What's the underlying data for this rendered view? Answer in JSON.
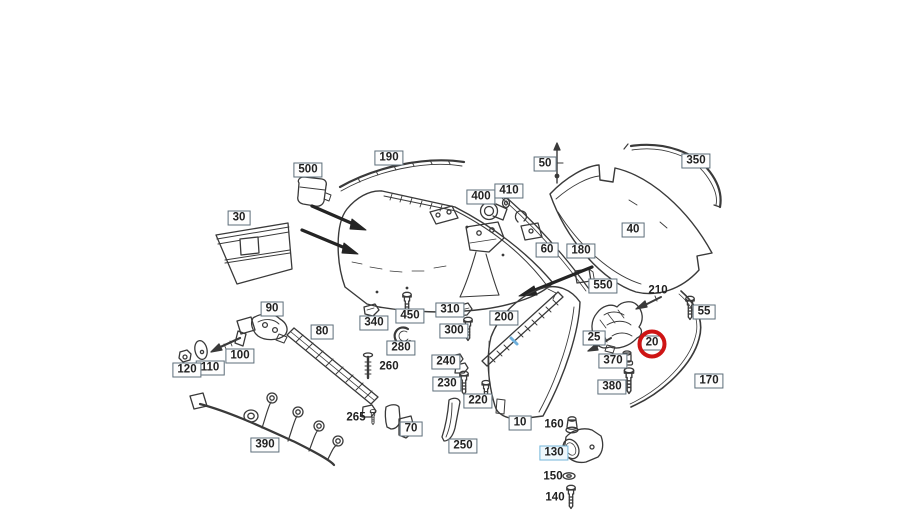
{
  "diagram": {
    "kind": "exploded-parts-diagram",
    "subject": "rear bumper assembly parts catalog drawing",
    "selected_callout": "20"
  },
  "colors": {
    "background": "#ffffff",
    "line": "#3a3a3a",
    "label_text": "#222222",
    "label_box_border": "#5d6e7a",
    "highlight_box_border": "#74b6d9",
    "highlight_ring": "#ce1414",
    "highlight_hatch": "#6fb0dc"
  },
  "labels": [
    {
      "text": "500",
      "x": 308,
      "y": 170,
      "boxed": true
    },
    {
      "text": "190",
      "x": 389,
      "y": 158,
      "boxed": true
    },
    {
      "text": "50",
      "x": 545,
      "y": 164,
      "boxed": true
    },
    {
      "text": "350",
      "x": 696,
      "y": 161,
      "boxed": true
    },
    {
      "text": "30",
      "x": 239,
      "y": 218,
      "boxed": true
    },
    {
      "text": "400",
      "x": 481,
      "y": 197,
      "boxed": true
    },
    {
      "text": "410",
      "x": 509,
      "y": 191,
      "boxed": true
    },
    {
      "text": "40",
      "x": 633,
      "y": 230,
      "boxed": true
    },
    {
      "text": "60",
      "x": 547,
      "y": 250,
      "boxed": true
    },
    {
      "text": "180",
      "x": 581,
      "y": 251,
      "boxed": true
    },
    {
      "text": "550",
      "x": 603,
      "y": 286,
      "boxed": true
    },
    {
      "text": "210",
      "x": 658,
      "y": 291,
      "boxed": false
    },
    {
      "text": "55",
      "x": 704,
      "y": 312,
      "boxed": true
    },
    {
      "text": "25",
      "x": 594,
      "y": 338,
      "boxed": true
    },
    {
      "text": "20",
      "x": 652,
      "y": 343,
      "boxed": true,
      "circled": true
    },
    {
      "text": "370",
      "x": 613,
      "y": 361,
      "boxed": true
    },
    {
      "text": "380",
      "x": 612,
      "y": 387,
      "boxed": true
    },
    {
      "text": "170",
      "x": 709,
      "y": 381,
      "boxed": true
    },
    {
      "text": "90",
      "x": 272,
      "y": 309,
      "boxed": true
    },
    {
      "text": "80",
      "x": 322,
      "y": 332,
      "boxed": true
    },
    {
      "text": "100",
      "x": 240,
      "y": 356,
      "boxed": true
    },
    {
      "text": "110",
      "x": 210,
      "y": 368,
      "boxed": true
    },
    {
      "text": "120",
      "x": 187,
      "y": 370,
      "boxed": true
    },
    {
      "text": "340",
      "x": 374,
      "y": 323,
      "boxed": true
    },
    {
      "text": "450",
      "x": 410,
      "y": 316,
      "boxed": true
    },
    {
      "text": "280",
      "x": 401,
      "y": 348,
      "boxed": true
    },
    {
      "text": "260",
      "x": 389,
      "y": 367,
      "boxed": false
    },
    {
      "text": "265",
      "x": 356,
      "y": 418,
      "boxed": false
    },
    {
      "text": "70",
      "x": 411,
      "y": 429,
      "boxed": true
    },
    {
      "text": "390",
      "x": 265,
      "y": 445,
      "boxed": true
    },
    {
      "text": "310",
      "x": 450,
      "y": 310,
      "boxed": true
    },
    {
      "text": "300",
      "x": 454,
      "y": 331,
      "boxed": true
    },
    {
      "text": "200",
      "x": 504,
      "y": 318,
      "boxed": true
    },
    {
      "text": "240",
      "x": 446,
      "y": 362,
      "boxed": true
    },
    {
      "text": "230",
      "x": 447,
      "y": 384,
      "boxed": true
    },
    {
      "text": "220",
      "x": 478,
      "y": 401,
      "boxed": true
    },
    {
      "text": "250",
      "x": 463,
      "y": 446,
      "boxed": true
    },
    {
      "text": "10",
      "x": 520,
      "y": 423,
      "boxed": true
    },
    {
      "text": "160",
      "x": 554,
      "y": 425,
      "boxed": false
    },
    {
      "text": "130",
      "x": 554,
      "y": 453,
      "boxed": true,
      "highlight": true
    },
    {
      "text": "150",
      "x": 553,
      "y": 477,
      "boxed": false
    },
    {
      "text": "140",
      "x": 555,
      "y": 498,
      "boxed": false
    }
  ]
}
